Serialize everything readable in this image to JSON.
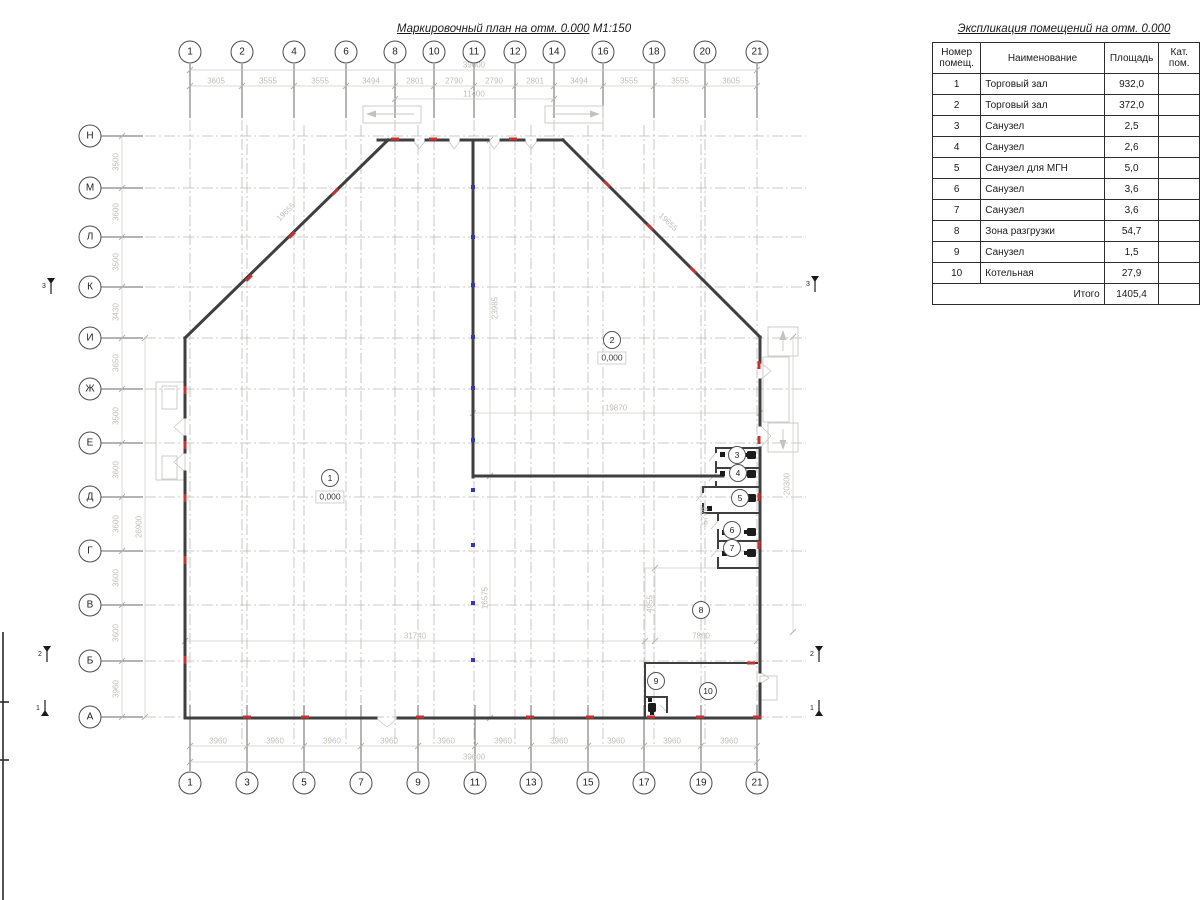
{
  "drawing": {
    "plan_title": "Маркировочный план на отм. 0.000",
    "plan_scale": "М1:150"
  },
  "schedule": {
    "title": "Экспликация помещений на отм. 0.000",
    "col_headers": [
      "Номер помещ.",
      "Наименование",
      "Площадь",
      "Кат. пом."
    ],
    "rows": [
      {
        "num": "1",
        "name": "Торговый зал",
        "area": "932,0",
        "kat": ""
      },
      {
        "num": "2",
        "name": "Торговый зал",
        "area": "372,0",
        "kat": ""
      },
      {
        "num": "3",
        "name": "Санузел",
        "area": "2,5",
        "kat": ""
      },
      {
        "num": "4",
        "name": "Санузел",
        "area": "2,6",
        "kat": ""
      },
      {
        "num": "5",
        "name": "Санузел для МГН",
        "area": "5,0",
        "kat": ""
      },
      {
        "num": "6",
        "name": "Санузел",
        "area": "3,6",
        "kat": ""
      },
      {
        "num": "7",
        "name": "Санузел",
        "area": "3,6",
        "kat": ""
      },
      {
        "num": "8",
        "name": "Зона разгрузки",
        "area": "54,7",
        "kat": ""
      },
      {
        "num": "9",
        "name": "Санузел",
        "area": "1,5",
        "kat": ""
      },
      {
        "num": "10",
        "name": "Котельная",
        "area": "27,9",
        "kat": ""
      }
    ],
    "total_label": "Итого",
    "total_value": "1405,4"
  },
  "axes": {
    "top": [
      {
        "l": "1",
        "x": 190
      },
      {
        "l": "2",
        "x": 242
      },
      {
        "l": "4",
        "x": 294
      },
      {
        "l": "6",
        "x": 346
      },
      {
        "l": "8",
        "x": 395
      },
      {
        "l": "10",
        "x": 434
      },
      {
        "l": "11",
        "x": 474
      },
      {
        "l": "12",
        "x": 515
      },
      {
        "l": "14",
        "x": 554
      },
      {
        "l": "16",
        "x": 603
      },
      {
        "l": "18",
        "x": 654
      },
      {
        "l": "20",
        "x": 705
      },
      {
        "l": "21",
        "x": 757
      }
    ],
    "bottom": [
      {
        "l": "1",
        "x": 190
      },
      {
        "l": "3",
        "x": 247
      },
      {
        "l": "5",
        "x": 304
      },
      {
        "l": "7",
        "x": 361
      },
      {
        "l": "9",
        "x": 418
      },
      {
        "l": "11",
        "x": 475
      },
      {
        "l": "13",
        "x": 531
      },
      {
        "l": "15",
        "x": 588
      },
      {
        "l": "17",
        "x": 644
      },
      {
        "l": "19",
        "x": 701
      },
      {
        "l": "21",
        "x": 757
      }
    ],
    "left": [
      {
        "l": "Н",
        "y": 136
      },
      {
        "l": "М",
        "y": 188
      },
      {
        "l": "Л",
        "y": 237
      },
      {
        "l": "К",
        "y": 287
      },
      {
        "l": "И",
        "y": 338
      },
      {
        "l": "Ж",
        "y": 389
      },
      {
        "l": "Е",
        "y": 443
      },
      {
        "l": "Д",
        "y": 497
      },
      {
        "l": "Г",
        "y": 551
      },
      {
        "l": "В",
        "y": 605
      },
      {
        "l": "Б",
        "y": 661
      },
      {
        "l": "А",
        "y": 717
      }
    ]
  },
  "dim_labels": [
    {
      "t": "39600",
      "x": 474,
      "y": 65
    },
    {
      "t": "3605",
      "x": 216,
      "y": 81
    },
    {
      "t": "3555",
      "x": 268,
      "y": 81
    },
    {
      "t": "3555",
      "x": 320,
      "y": 81
    },
    {
      "t": "3494",
      "x": 371,
      "y": 81
    },
    {
      "t": "2801",
      "x": 415,
      "y": 81
    },
    {
      "t": "2790",
      "x": 454,
      "y": 81
    },
    {
      "t": "2790",
      "x": 494,
      "y": 81
    },
    {
      "t": "2801",
      "x": 535,
      "y": 81
    },
    {
      "t": "3494",
      "x": 579,
      "y": 81
    },
    {
      "t": "3555",
      "x": 629,
      "y": 81
    },
    {
      "t": "3555",
      "x": 680,
      "y": 81
    },
    {
      "t": "3605",
      "x": 731,
      "y": 81
    },
    {
      "t": "11400",
      "x": 474,
      "y": 94
    },
    {
      "t": "3960",
      "x": 218,
      "y": 741
    },
    {
      "t": "3960",
      "x": 275,
      "y": 741
    },
    {
      "t": "3960",
      "x": 332,
      "y": 741
    },
    {
      "t": "3960",
      "x": 389,
      "y": 741
    },
    {
      "t": "3960",
      "x": 446,
      "y": 741
    },
    {
      "t": "3960",
      "x": 503,
      "y": 741
    },
    {
      "t": "3960",
      "x": 559,
      "y": 741
    },
    {
      "t": "3960",
      "x": 616,
      "y": 741
    },
    {
      "t": "3960",
      "x": 672,
      "y": 741
    },
    {
      "t": "3960",
      "x": 729,
      "y": 741
    },
    {
      "t": "39600",
      "x": 474,
      "y": 757
    },
    {
      "t": "3500",
      "x": 116,
      "y": 162,
      "r": -90
    },
    {
      "t": "3600",
      "x": 116,
      "y": 212,
      "r": -90
    },
    {
      "t": "3500",
      "x": 116,
      "y": 262,
      "r": -90
    },
    {
      "t": "3430",
      "x": 116,
      "y": 312,
      "r": -90
    },
    {
      "t": "3650",
      "x": 116,
      "y": 363,
      "r": -90
    },
    {
      "t": "3500",
      "x": 116,
      "y": 416,
      "r": -90
    },
    {
      "t": "3600",
      "x": 116,
      "y": 470,
      "r": -90
    },
    {
      "t": "3600",
      "x": 116,
      "y": 524,
      "r": -90
    },
    {
      "t": "3600",
      "x": 116,
      "y": 578,
      "r": -90
    },
    {
      "t": "3600",
      "x": 116,
      "y": 633,
      "r": -90
    },
    {
      "t": "3960",
      "x": 116,
      "y": 689,
      "r": -90
    },
    {
      "t": "26900",
      "x": 139,
      "y": 527,
      "r": -90
    },
    {
      "t": "20300",
      "x": 787,
      "y": 484,
      "r": -90
    },
    {
      "t": "31740",
      "x": 415,
      "y": 636
    },
    {
      "t": "7860",
      "x": 701,
      "y": 636
    },
    {
      "t": "19870",
      "x": 616,
      "y": 408
    },
    {
      "t": "16575",
      "x": 485,
      "y": 598,
      "r": -90
    },
    {
      "t": "23985",
      "x": 495,
      "y": 308,
      "r": -90
    },
    {
      "t": "4955",
      "x": 650,
      "y": 604,
      "r": -90
    },
    {
      "t": "5770",
      "x": 705,
      "y": 516,
      "r": -90
    },
    {
      "t": "19655",
      "x": 286,
      "y": 212,
      "r": -44
    },
    {
      "t": "19655",
      "x": 668,
      "y": 222,
      "r": 44
    }
  ],
  "rooms": [
    {
      "n": "1",
      "x": 330,
      "y": 478,
      "elev": "0,000",
      "ey": 497
    },
    {
      "n": "2",
      "x": 612,
      "y": 340,
      "elev": "0,000",
      "ey": 358
    },
    {
      "n": "3",
      "x": 737,
      "y": 455
    },
    {
      "n": "4",
      "x": 738,
      "y": 473
    },
    {
      "n": "5",
      "x": 740,
      "y": 498
    },
    {
      "n": "6",
      "x": 732,
      "y": 530
    },
    {
      "n": "7",
      "x": 732,
      "y": 548
    },
    {
      "n": "8",
      "x": 701,
      "y": 610
    },
    {
      "n": "9",
      "x": 656,
      "y": 681
    },
    {
      "n": "10",
      "x": 708,
      "y": 691
    }
  ],
  "red_marks": [
    {
      "x": 247,
      "y": 717,
      "o": "h"
    },
    {
      "x": 305,
      "y": 717,
      "o": "h"
    },
    {
      "x": 420,
      "y": 717,
      "o": "h"
    },
    {
      "x": 530,
      "y": 717,
      "o": "h"
    },
    {
      "x": 590,
      "y": 717,
      "o": "h"
    },
    {
      "x": 651,
      "y": 717,
      "o": "h"
    },
    {
      "x": 700,
      "y": 717,
      "o": "h"
    },
    {
      "x": 757,
      "y": 717,
      "o": "h"
    },
    {
      "x": 751,
      "y": 663,
      "o": "h"
    },
    {
      "x": 395,
      "y": 139,
      "o": "h"
    },
    {
      "x": 433,
      "y": 139,
      "o": "h"
    },
    {
      "x": 513,
      "y": 139,
      "o": "h"
    },
    {
      "x": 185,
      "y": 390,
      "o": "v"
    },
    {
      "x": 185,
      "y": 445,
      "o": "v"
    },
    {
      "x": 185,
      "y": 498,
      "o": "v"
    },
    {
      "x": 185,
      "y": 560,
      "o": "v"
    },
    {
      "x": 185,
      "y": 660,
      "o": "v"
    },
    {
      "x": 759,
      "y": 365,
      "o": "v"
    },
    {
      "x": 759,
      "y": 440,
      "o": "v"
    },
    {
      "x": 759,
      "y": 497,
      "o": "v"
    },
    {
      "x": 759,
      "y": 545,
      "o": "v"
    },
    {
      "x": 249,
      "y": 278,
      "o": "d1"
    },
    {
      "x": 292,
      "y": 235,
      "o": "d1"
    },
    {
      "x": 335,
      "y": 192,
      "o": "d1"
    },
    {
      "x": 607,
      "y": 184,
      "o": "d2"
    },
    {
      "x": 650,
      "y": 227,
      "o": "d2"
    },
    {
      "x": 693,
      "y": 270,
      "o": "d2"
    }
  ],
  "blue_marks": [
    {
      "x": 473,
      "y": 187
    },
    {
      "x": 473,
      "y": 237
    },
    {
      "x": 473,
      "y": 285
    },
    {
      "x": 473,
      "y": 337
    },
    {
      "x": 473,
      "y": 388
    },
    {
      "x": 473,
      "y": 440
    },
    {
      "x": 473,
      "y": 490
    },
    {
      "x": 473,
      "y": 545
    },
    {
      "x": 473,
      "y": 603
    },
    {
      "x": 473,
      "y": 660
    }
  ],
  "section_marks": [
    {
      "n": "3",
      "x": 42,
      "y": 286,
      "d": "down"
    },
    {
      "n": "2",
      "x": 38,
      "y": 654,
      "d": "down"
    },
    {
      "n": "1",
      "x": 36,
      "y": 708,
      "d": "up"
    },
    {
      "n": "3",
      "x": 806,
      "y": 284,
      "d": "down"
    },
    {
      "n": "2",
      "x": 810,
      "y": 654,
      "d": "down"
    },
    {
      "n": "1",
      "x": 810,
      "y": 708,
      "d": "up"
    }
  ],
  "colors": {
    "wall": "#3f3f3f",
    "grid": "#bcbab8",
    "dim_line": "#cfccc8",
    "dim_text": "#c3bfba",
    "red": "#c8322e",
    "blue": "#3339b0",
    "light": "#d5d3d1",
    "stem": "#6a6a6a"
  }
}
